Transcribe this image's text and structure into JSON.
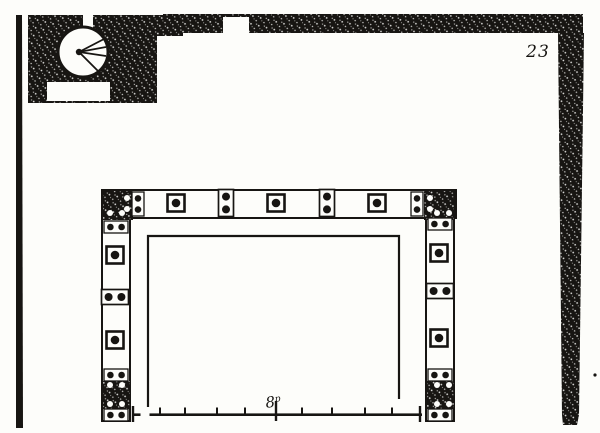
{
  "page": {
    "number": "23"
  },
  "colors": {
    "ink": "#171512",
    "paper": "#fdfdfa"
  },
  "scale_bar": {
    "label": "8",
    "label_sup": "p",
    "end_ticks": [
      133,
      420
    ],
    "minor_ticks": [
      160,
      185,
      217,
      245,
      302,
      332,
      365,
      392
    ],
    "major_tick": 276
  },
  "frame": {
    "bolts": [
      {
        "x": 176,
        "y": 203
      },
      {
        "x": 276,
        "y": 203
      },
      {
        "x": 377,
        "y": 203
      },
      {
        "x": 115,
        "y": 255
      },
      {
        "x": 115,
        "y": 340
      },
      {
        "x": 439,
        "y": 253
      },
      {
        "x": 439,
        "y": 338
      }
    ],
    "dot_pairs": [
      {
        "x": 226,
        "y": 203,
        "orient": "v",
        "style": "plate"
      },
      {
        "x": 327,
        "y": 203,
        "orient": "v",
        "style": "plate"
      },
      {
        "x": 138,
        "y": 204,
        "orient": "v",
        "style": "strap"
      },
      {
        "x": 417,
        "y": 204,
        "orient": "v",
        "style": "strap"
      },
      {
        "x": 116,
        "y": 227,
        "orient": "h",
        "style": "strap"
      },
      {
        "x": 115,
        "y": 297,
        "orient": "h",
        "style": "plate"
      },
      {
        "x": 116,
        "y": 375,
        "orient": "h",
        "style": "strap"
      },
      {
        "x": 116,
        "y": 415,
        "orient": "h",
        "style": "strap"
      },
      {
        "x": 440,
        "y": 224,
        "orient": "h",
        "style": "strap"
      },
      {
        "x": 440,
        "y": 291,
        "orient": "h",
        "style": "plate"
      },
      {
        "x": 440,
        "y": 375,
        "orient": "h",
        "style": "strap"
      },
      {
        "x": 440,
        "y": 415,
        "orient": "h",
        "style": "strap"
      }
    ],
    "block_dots": [
      {
        "x": 110,
        "y": 213
      },
      {
        "x": 122,
        "y": 213
      },
      {
        "x": 127,
        "y": 198
      },
      {
        "x": 127,
        "y": 209
      },
      {
        "x": 437,
        "y": 213
      },
      {
        "x": 449,
        "y": 213
      },
      {
        "x": 430,
        "y": 198
      },
      {
        "x": 430,
        "y": 209
      },
      {
        "x": 110,
        "y": 385
      },
      {
        "x": 122,
        "y": 385
      },
      {
        "x": 110,
        "y": 404
      },
      {
        "x": 122,
        "y": 404
      },
      {
        "x": 437,
        "y": 385
      },
      {
        "x": 449,
        "y": 385
      },
      {
        "x": 437,
        "y": 404
      },
      {
        "x": 449,
        "y": 404
      }
    ]
  }
}
